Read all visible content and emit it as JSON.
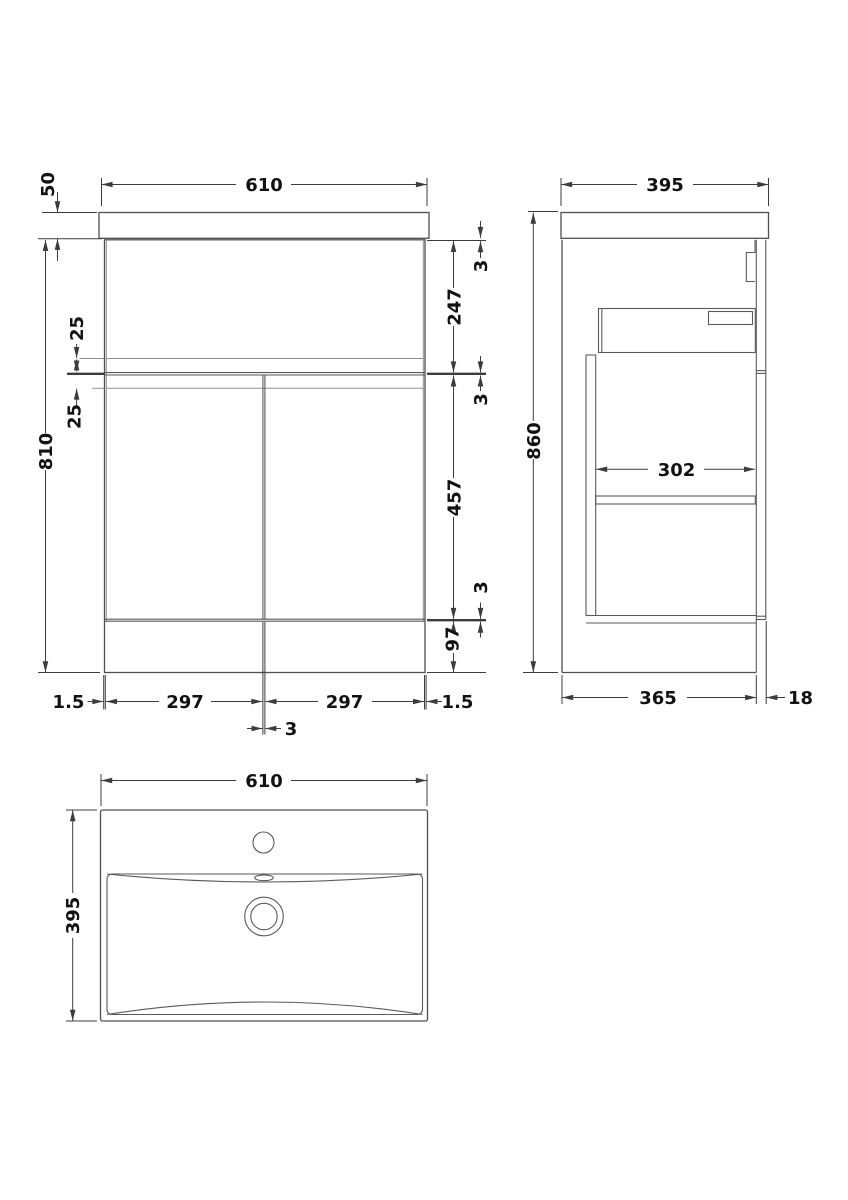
{
  "meta": {
    "drawing_type": "vanity-unit-dimension-drawing",
    "background_color": "#ffffff",
    "line_color": "#4f4f4f",
    "dimension_color": "#3c3c3c",
    "text_color": "#121212"
  },
  "front_view": {
    "width_top": "610",
    "worktop_height": "50",
    "cabinet_height": "810",
    "top_gap": "3",
    "drawer_front_height": "247",
    "mid_gap": "3",
    "door_height": "457",
    "bottom_gap": "3",
    "plinth_height": "97",
    "upper_rail_offset": "25",
    "lower_rail_offset": "25",
    "left_edge_gap": "1.5",
    "left_door_width": "297",
    "right_door_width": "297",
    "right_edge_gap": "1.5",
    "center_door_gap": "3"
  },
  "side_view": {
    "depth": "395",
    "overall_height": "860",
    "internal_depth": "302",
    "carcass_depth": "365",
    "front_panel_thickness": "18"
  },
  "plan_view": {
    "basin_width": "610",
    "basin_depth": "395"
  }
}
